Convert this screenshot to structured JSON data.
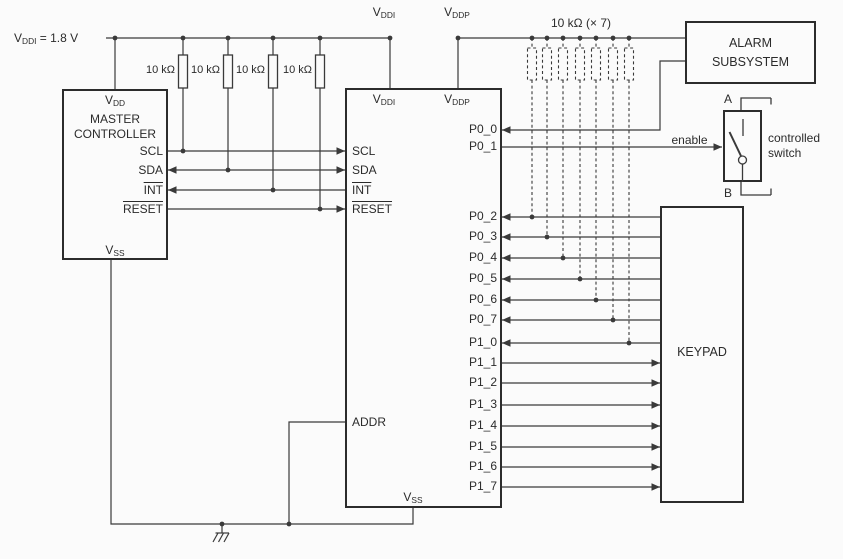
{
  "colors": {
    "background": "#fbfbfb",
    "line": "#3a3a3a",
    "text": "#2b2b2b"
  },
  "power": {
    "vddi_rail": {
      "base": "V",
      "sub": "DDI",
      "suffix": " = 1.8 V"
    },
    "vddi_top": {
      "base": "V",
      "sub": "DDI"
    },
    "vddp_top": {
      "base": "V",
      "sub": "DDP"
    },
    "pullup_resistor": "10 kΩ",
    "pullup_bank": "10 kΩ (× 7)"
  },
  "master": {
    "vdd": {
      "base": "V",
      "sub": "DD"
    },
    "title_1": "MASTER",
    "title_2": "CONTROLLER",
    "pin_scl": "SCL",
    "pin_sda": "SDA",
    "pin_int": "INT",
    "pin_reset": "RESET",
    "vss": {
      "base": "V",
      "sub": "SS"
    }
  },
  "expander": {
    "vddi": {
      "base": "V",
      "sub": "DDI"
    },
    "vddp": {
      "base": "V",
      "sub": "DDP"
    },
    "pin_scl": "SCL",
    "pin_sda": "SDA",
    "pin_int": "INT",
    "pin_reset": "RESET",
    "pin_addr": "ADDR",
    "right_pins": [
      "P0_0",
      "P0_1",
      "P0_2",
      "P0_3",
      "P0_4",
      "P0_5",
      "P0_6",
      "P0_7",
      "P1_0",
      "P1_1",
      "P1_2",
      "P1_3",
      "P1_4",
      "P1_5",
      "P1_6",
      "P1_7"
    ],
    "vss": {
      "base": "V",
      "sub": "SS"
    }
  },
  "alarm": {
    "title_1": "ALARM",
    "title_2": "SUBSYSTEM"
  },
  "keypad": {
    "title": "KEYPAD"
  },
  "switch": {
    "terminal_a": "A",
    "terminal_b": "B",
    "enable": "enable",
    "caption_1": "controlled",
    "caption_2": "switch"
  }
}
